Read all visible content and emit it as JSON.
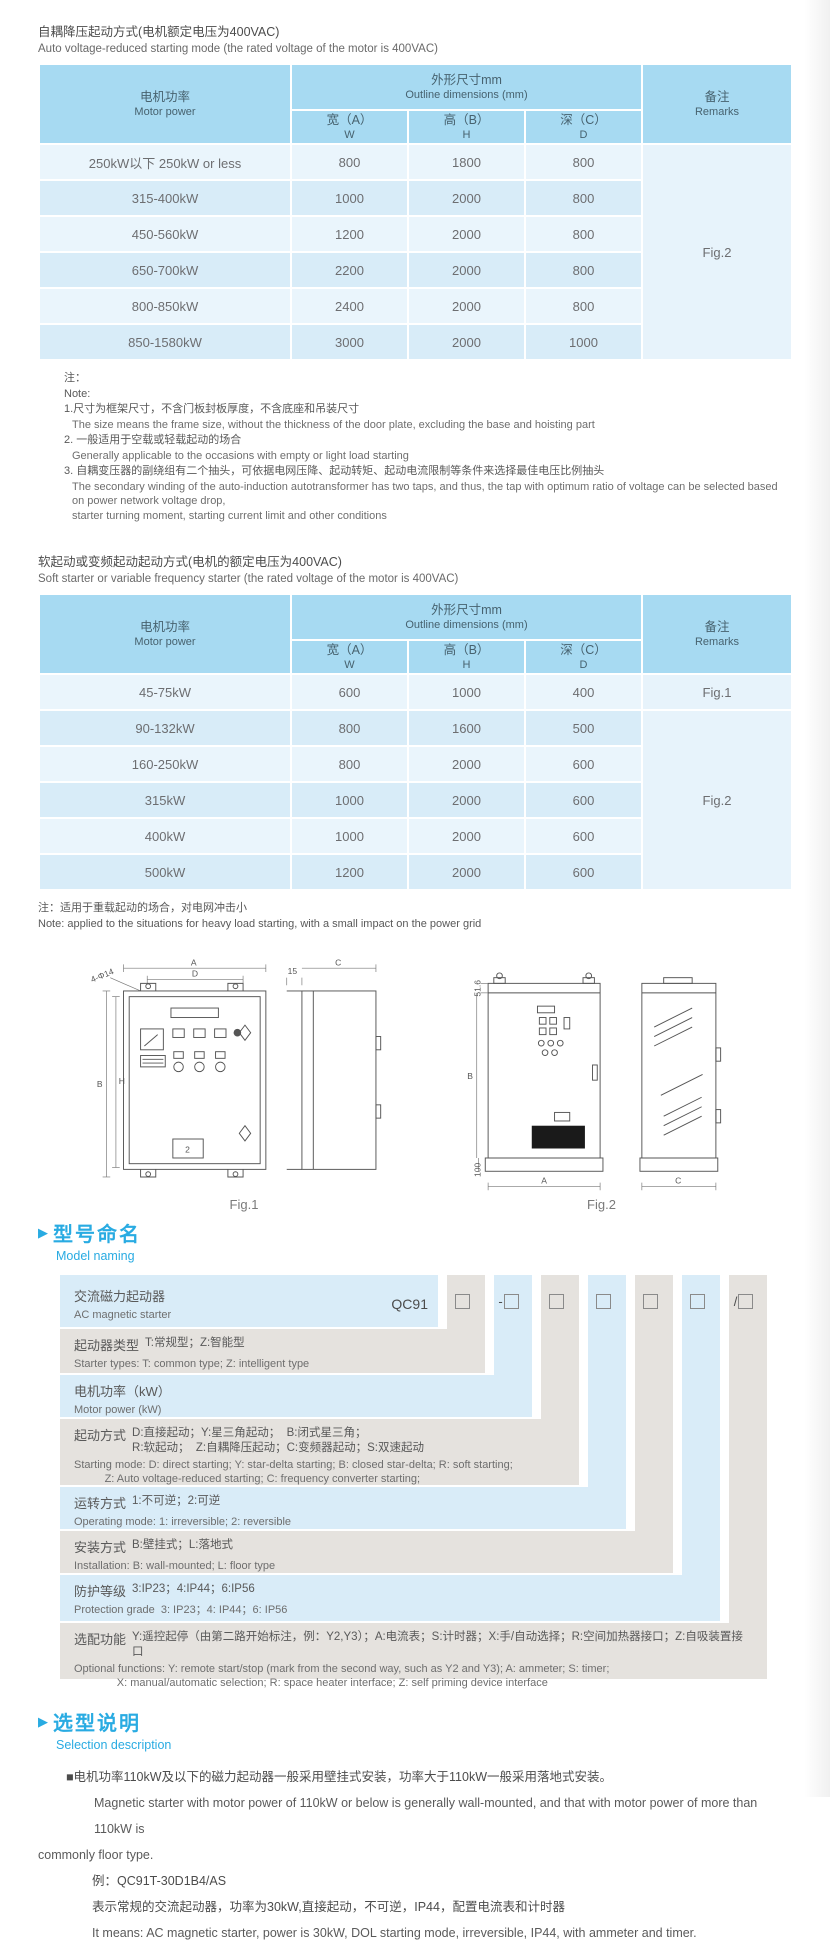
{
  "auto": {
    "title_zh": "自耦降压起动方式(电机额定电压为400VAC)",
    "title_en": "Auto voltage-reduced starting mode (the rated voltage of the motor is 400VAC)",
    "table": {
      "motor_zh": "电机功率",
      "motor_en": "Motor power",
      "dims_zh": "外形尺寸mm",
      "dims_en": "Outline dimensions (mm)",
      "w_zh": "宽（A）",
      "w_en": "W",
      "h_zh": "高（B）",
      "h_en": "H",
      "d_zh": "深（C）",
      "d_en": "D",
      "rem_zh": "备注",
      "rem_en": "Remarks",
      "remark": "Fig.2",
      "rows": [
        {
          "power": "250kW以下 250kW or less",
          "w": "800",
          "h": "1800",
          "d": "800"
        },
        {
          "power": "315-400kW",
          "w": "1000",
          "h": "2000",
          "d": "800"
        },
        {
          "power": "450-560kW",
          "w": "1200",
          "h": "2000",
          "d": "800"
        },
        {
          "power": "650-700kW",
          "w": "2200",
          "h": "2000",
          "d": "800"
        },
        {
          "power": "800-850kW",
          "w": "2400",
          "h": "2000",
          "d": "800"
        },
        {
          "power": "850-1580kW",
          "w": "3000",
          "h": "2000",
          "d": "1000"
        }
      ]
    },
    "note_label_zh": "注：",
    "note_label_en": "Note:",
    "notes": [
      {
        "zh": "1.尺寸为框架尺寸，不含门板封板厚度，不含底座和吊装尺寸",
        "en": "The size means the frame size, without the thickness of the door plate, excluding the base and hoisting part"
      },
      {
        "zh": "2. 一般适用于空载或轻载起动的场合",
        "en": "Generally applicable to the occasions with empty or light load starting"
      },
      {
        "zh": "3. 自耦变压器的副绕组有二个抽头，可依据电网压降、起动转矩、起动电流限制等条件来选择最佳电压比例抽头",
        "en": "The secondary winding of the auto-induction autotransformer has two taps, and thus, the tap with optimum ratio of voltage can be selected based on power network voltage drop,\nstarter turning moment, starting current limit and other conditions"
      }
    ]
  },
  "soft": {
    "title_zh": "软起动或变频起动起动方式(电机的额定电压为400VAC)",
    "title_en": "Soft starter or variable frequency starter (the rated voltage of the motor is 400VAC)",
    "table": {
      "motor_zh": "电机功率",
      "motor_en": "Motor power",
      "dims_zh": "外形尺寸mm",
      "dims_en": "Outline dimensions (mm)",
      "w_zh": "宽（A）",
      "w_en": "W",
      "h_zh": "高（B）",
      "h_en": "H",
      "d_zh": "深（C）",
      "d_en": "D",
      "rem_zh": "备注",
      "rem_en": "Remarks",
      "remark_row1": "Fig.1",
      "remark_merged": "Fig.2",
      "rows": [
        {
          "power": "45-75kW",
          "w": "600",
          "h": "1000",
          "d": "400"
        },
        {
          "power": "90-132kW",
          "w": "800",
          "h": "1600",
          "d": "500"
        },
        {
          "power": "160-250kW",
          "w": "800",
          "h": "2000",
          "d": "600"
        },
        {
          "power": "315kW",
          "w": "1000",
          "h": "2000",
          "d": "600"
        },
        {
          "power": "400kW",
          "w": "1000",
          "h": "2000",
          "d": "600"
        },
        {
          "power": "500kW",
          "w": "1200",
          "h": "2000",
          "d": "600"
        }
      ]
    },
    "note_zh": "注：适用于重载起动的场合，对电网冲击小",
    "note_en": "Note: applied to the situations for heavy load starting, with a small impact on the power grid"
  },
  "figs": {
    "fig1": {
      "caption": "Fig.1",
      "a": "A",
      "d": "D",
      "callout": "4-Φ14",
      "b": "B",
      "h": "H",
      "s15": "15",
      "c": "C",
      "panel_num": "2"
    },
    "fig2": {
      "caption": "Fig.2",
      "top": "51.6",
      "b": "B",
      "base": "100",
      "a": "A",
      "c": "C"
    }
  },
  "model": {
    "heading_zh": "型号命名",
    "heading_en": "Model naming",
    "code_prefix": "QC91",
    "box_prefixes": [
      "",
      "-",
      "",
      "",
      "",
      "",
      "/"
    ],
    "rows": [
      {
        "zh_label": "交流磁力起动器",
        "zh_desc": "",
        "en": "AC magnetic starter"
      },
      {
        "zh_label": "起动器类型",
        "zh_desc": "T:常规型；Z:智能型",
        "en": "Starter types: T: common type; Z: intelligent type"
      },
      {
        "zh_label": "电机功率（kW）",
        "zh_desc": "",
        "en": "Motor power (kW)"
      },
      {
        "zh_label": "起动方式",
        "zh_desc": "D:直接起动；Y:星三角起动；  B:闭式星三角；\nR:软起动；  Z:自耦降压起动；C:变频器起动；S:双速起动",
        "en": "Starting mode: D: direct starting; Y: star-delta starting; B: closed star-delta; R: soft starting;\n          Z: Auto voltage-reduced starting; C: frequency converter starting;\n          S: double speed starting"
      },
      {
        "zh_label": "运转方式",
        "zh_desc": "1:不可逆；2:可逆",
        "en": "Operating mode: 1: irreversible; 2: reversible"
      },
      {
        "zh_label": "安装方式",
        "zh_desc": "B:壁挂式；L:落地式",
        "en": "Installation: B: wall-mounted; L: floor type"
      },
      {
        "zh_label": "防护等级",
        "zh_desc": "3:IP23；4:IP44；6:IP56",
        "en": "Protection grade  3: IP23；4: IP44；6: IP56"
      },
      {
        "zh_label": "选配功能",
        "zh_desc": "Y:遥控起停（由第二路开始标注，例：Y2,Y3）；A:电流表；S:计时器；X:手/自动选择；R:空间加热器接口；Z:自吸装置接口",
        "en": "Optional functions: Y: remote start/stop (mark from the second way, such as Y2 and Y3); A: ammeter; S: timer;\n              X: manual/automatic selection; R: space heater interface; Z: self priming device interface"
      }
    ]
  },
  "sel": {
    "heading_zh": "选型说明",
    "heading_en": "Selection description",
    "p1_zh": "■电机功率110kW及以下的磁力起动器一般采用壁挂式安装，功率大于110kW一般采用落地式安装。",
    "p1_en1": "Magnetic starter with motor power of 110kW or below is generally wall-mounted, and that with motor power of more than 110kW is",
    "p1_en2": "commonly floor type.",
    "example_code": "例：QC91T-30D1B4/AS",
    "example_zh": "表示常规的交流起动器，功率为30kW,直接起动，不可逆，IP44，配置电流表和计时器",
    "example_en": "It means: AC magnetic starter, power is 30kW, DOL starting mode, irreversible, IP44, with ammeter and timer."
  }
}
